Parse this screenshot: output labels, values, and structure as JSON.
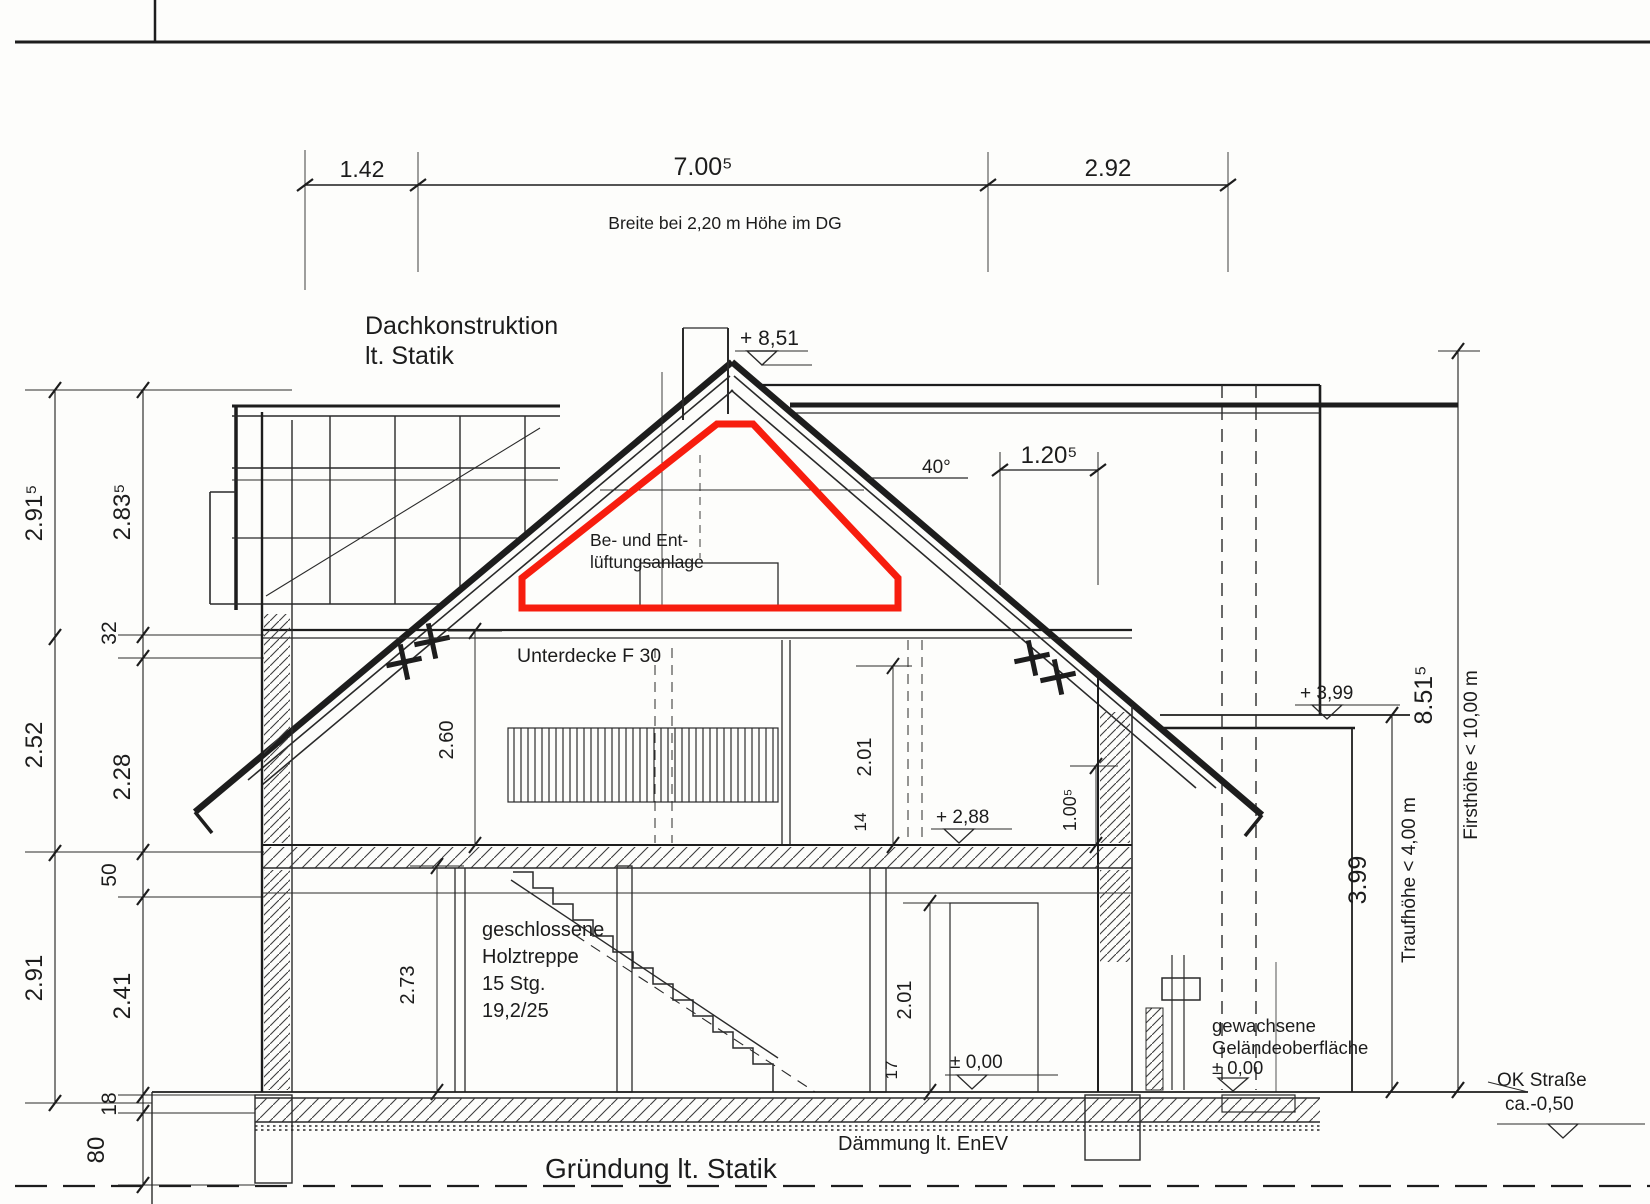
{
  "labels": {
    "roof_construction_line1": "Dachkonstruktion",
    "roof_construction_line2": "lt. Statik",
    "ceiling": "Unterdecke F 30",
    "vent_line1": "Be-  und  Ent-",
    "vent_line2": "lüftungsanlage",
    "stairs_line1": "geschlossene",
    "stairs_line2": "Holztreppe",
    "stairs_line3": "15 Stg.",
    "stairs_line4": "19,2/25",
    "insulation": "Dämmung  lt.  EnEV",
    "foundation": "Gründung  lt.  Statik",
    "terrain_line1": "gewachsene",
    "terrain_line2": "Geländeoberfläche",
    "terrain_line3": "± 0,00",
    "street_line1": "OK  Straße",
    "street_line2": "ca.-0,50"
  },
  "levels": {
    "ridge": "+ 8,51",
    "upper_floor": "+ 2,88",
    "ground_floor": "± 0,00",
    "annex_roof": "+ 3,99"
  },
  "dimensions": {
    "top_left": "1.42",
    "top_middle": "7.00⁵",
    "top_right": "2.92",
    "top_note": "Breite  bei  2,20  m  Höhe  im  DG",
    "left_outer_top": "2.91⁵",
    "left_outer_mid": "2.52",
    "left_outer_bottom": "2.91",
    "left_inner_top": "2.83⁵",
    "left_inner_32": "32",
    "left_inner_mid": "2.28",
    "left_inner_50": "50",
    "left_inner_low": "2.41",
    "left_inner_18": "18",
    "left_inner_80": "80",
    "dg_room_height": "2.60",
    "dg_door_height": "2.01",
    "dg_lintel": "14",
    "dg_parapet": "1.00⁵",
    "eg_room_height": "2.73",
    "eg_door_height": "2.01",
    "eg_step": "17",
    "dormer_width": "1.20⁵",
    "roof_pitch": "40°",
    "eaves_height_value": "3.99",
    "eaves_height_label": "Traufhöhe  <  4,00  m",
    "ridge_height_value": "8.51⁵",
    "ridge_height_label": "Firsthöhe  <  10,00  m"
  },
  "highlight": {
    "color": "#f71d0e"
  }
}
